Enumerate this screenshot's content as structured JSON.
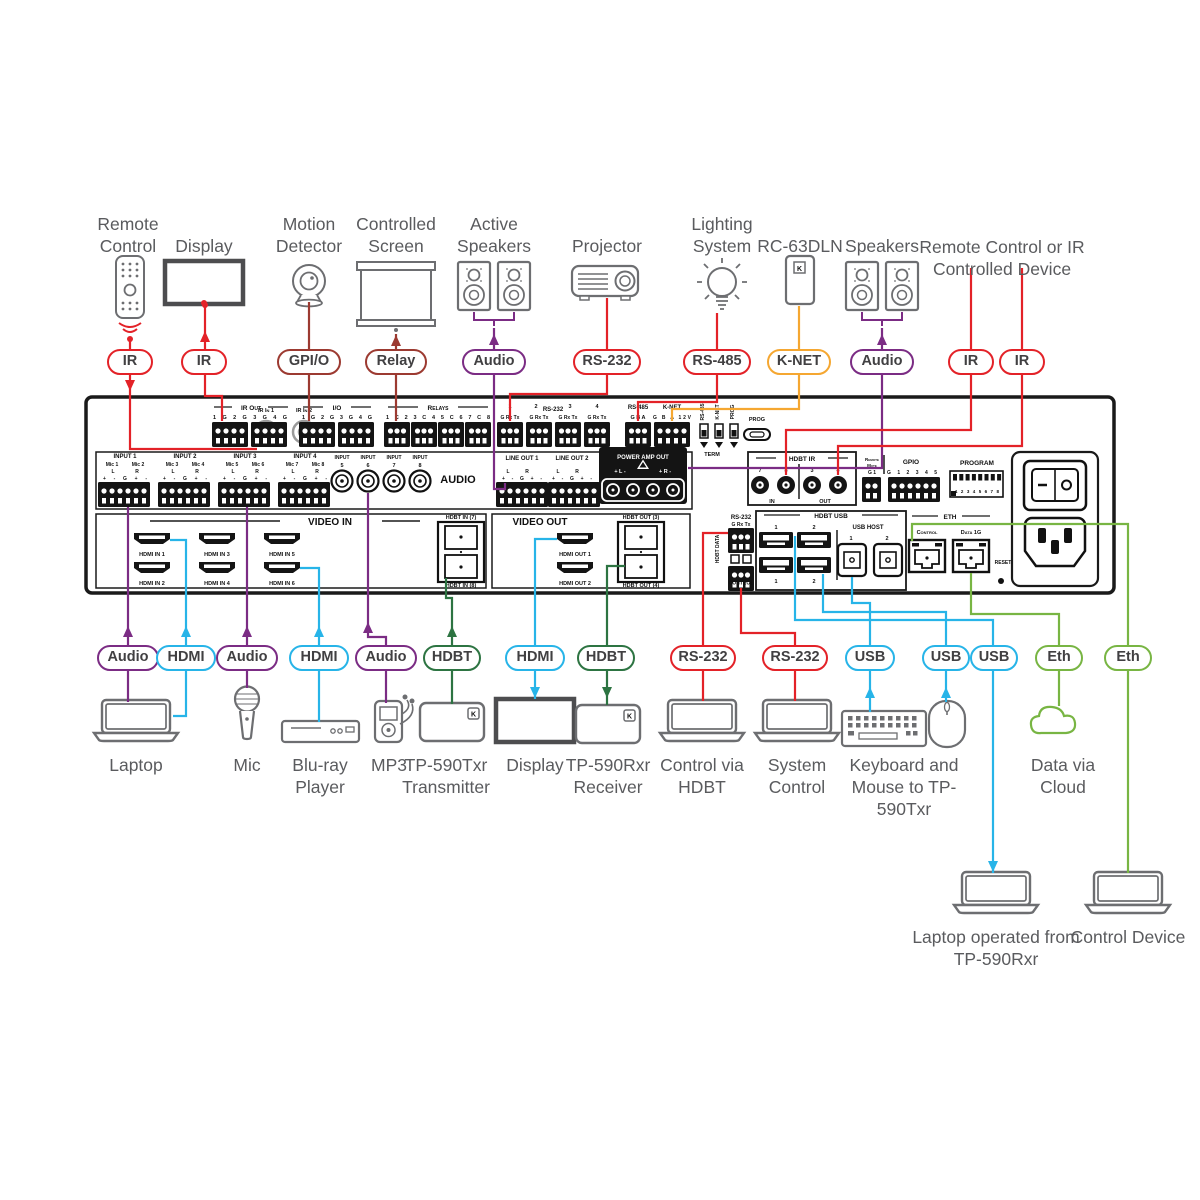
{
  "colors": {
    "ir_rs232_red": "#e32228",
    "gpio_relay_dark_red": "#9c3a31",
    "audio_purple": "#7b2c84",
    "knet_orange": "#f5a731",
    "hdmi_usb_cyan": "#27b4e8",
    "hdbt_green": "#2d7442",
    "eth_light_green": "#78b543",
    "badge_text": "#414042",
    "device_label_gray": "#5a5b5e",
    "panel_black": "#141414"
  },
  "k_logo": "K",
  "badges": {
    "top": [
      "IR",
      "IR",
      "GPI/O",
      "Relay",
      "Audio",
      "RS-232",
      "RS-485",
      "K-NET",
      "Audio",
      "IR",
      "IR"
    ],
    "bottom": [
      "Audio",
      "HDMI",
      "Audio",
      "HDMI",
      "Audio",
      "HDBT",
      "HDMI",
      "HDBT",
      "RS-232",
      "RS-232",
      "USB",
      "USB",
      "USB",
      "Eth",
      "Eth"
    ]
  },
  "top_devices": [
    "Remote Control",
    "Display",
    "Motion Detector",
    "Controlled Screen",
    "Active Speakers",
    "Projector",
    "Lighting System",
    "RC-63DLN",
    "Speakers",
    "Remote Control or IR Controlled Device"
  ],
  "bottom_devices": [
    "Laptop",
    "Mic",
    "Blu-ray Player",
    "MP3",
    "TP-590Txr Transmitter",
    "Display",
    "TP-590Rxr Receiver",
    "Control via HDBT",
    "System Control",
    "Keyboard and Mouse to TP-590Txr",
    "Data via Cloud",
    "Laptop operated from TP-590Rxr",
    "Control Device"
  ],
  "panel": {
    "ir_in_1": "IR In 1",
    "ir_in_2": "IR In 2",
    "ir_out": "IR Out",
    "ir_out_pins": "1 G 2 G 3 G 4 G",
    "io": "I/O",
    "io_pins": "1 G 2 G 3 G 4 G",
    "relays": "Relays",
    "relays_pins": "1 C 2 3 C 4 5 C 6 7 C 8",
    "rs232": "RS-232",
    "rs232_pins": "G Rx Tx",
    "rs485": "RS-485",
    "rs485_pins": "G B A",
    "knet": "K-NET",
    "knet_pins": "G B A 12V",
    "sw_rs485": "RS-485",
    "sw_knet": "K-NET",
    "sw_prog": "PROG",
    "term": "TERM",
    "prog": "PROG",
    "hdbt_ir": "HDBT IR",
    "in": "IN",
    "out": "OUT",
    "n1": "1",
    "n2": "2",
    "n3": "3",
    "n4": "4",
    "n7": "7",
    "n8": "8",
    "remote1": "Remote",
    "remote2": "Mute",
    "rm_pins": "G 1",
    "gpio": "GPIO",
    "gpio_pins": "G 1 2 3 4 5",
    "program": "PROGRAM",
    "program_pins": "1 2 3 4 5 6 7 8",
    "input_titles": [
      "INPUT 1",
      "INPUT 2",
      "INPUT 3",
      "INPUT 4"
    ],
    "mics": [
      "Mic 1",
      "Mic 2",
      "Mic 3",
      "Mic 4",
      "Mic 5",
      "Mic 6",
      "Mic 7",
      "Mic 8"
    ],
    "l": "L",
    "r": "R",
    "mic_pins": "+ - G + -",
    "input_word": "INPUT",
    "rca_nums": [
      "5",
      "6",
      "7",
      "8"
    ],
    "audio": "AUDIO",
    "line_out_titles": [
      "LINE OUT 1",
      "LINE OUT 2"
    ],
    "lo_pins": "+ - G + -",
    "power_amp": "POWER AMP OUT",
    "pa_l": "+ L -",
    "pa_r": "+ R -",
    "video_in": "VIDEO IN",
    "hdmi_in": [
      "HDMI IN 1",
      "HDMI IN 2",
      "HDMI IN 3",
      "HDMI IN 4",
      "HDMI IN 5",
      "HDMI IN 6"
    ],
    "hdbt_in7": "HDBT IN (7)",
    "hdbt_in8": "HDBT IN (8)",
    "video_out": "VIDEO OUT",
    "hdmi_out": [
      "HDMI OUT 1",
      "HDMI OUT 2"
    ],
    "hdbt_out3": "HDBT OUT (3)",
    "hdbt_out4": "HDBT OUT (4)",
    "hdbt_data": "HDBT DATA",
    "hd_rs232": "RS-232",
    "hd_pins": "G Rx Tx",
    "control": "CONTROL",
    "hdbt_usb": "HDBT USB",
    "usb_host": "USB HOST",
    "eth": "ETH",
    "eth_control": "Control",
    "eth_data": "Data 1G",
    "reset": "RESET"
  }
}
